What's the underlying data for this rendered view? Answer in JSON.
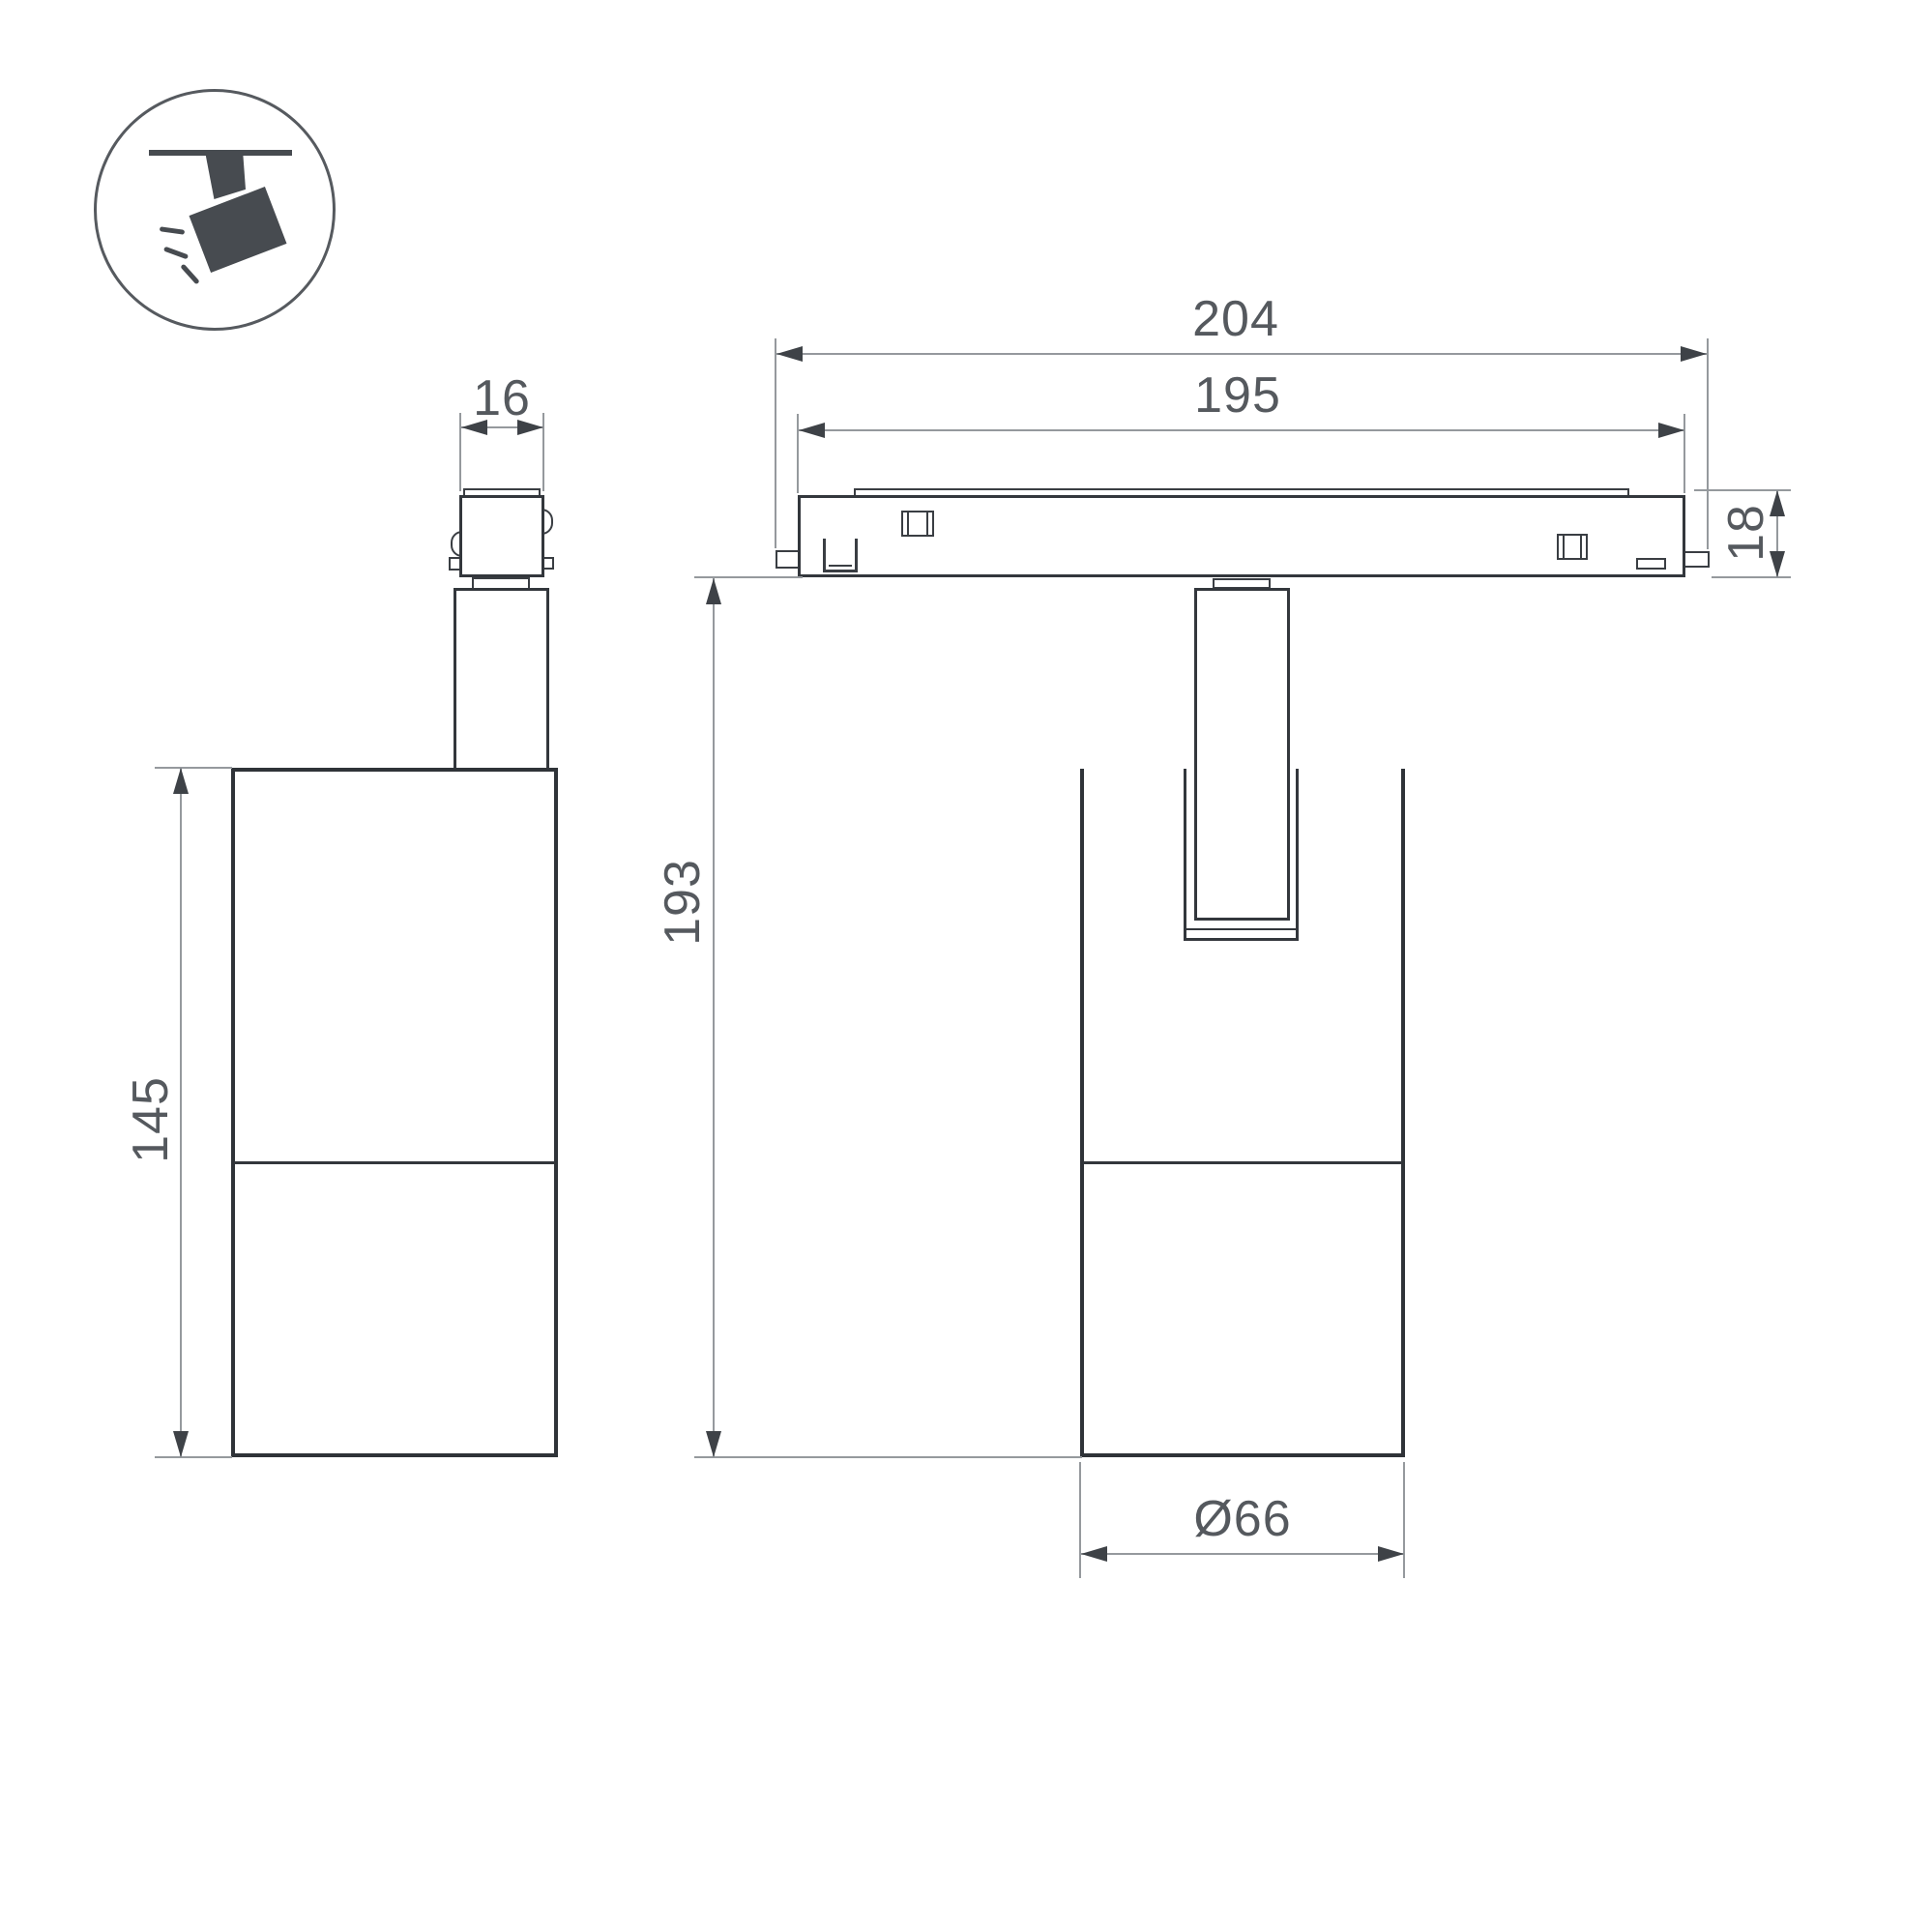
{
  "icon": {
    "name": "ceiling-track-spotlight-icon"
  },
  "dims": {
    "adapter_width": {
      "label": "16"
    },
    "track_length_overall": {
      "label": "204"
    },
    "track_length_body": {
      "label": "195"
    },
    "track_height": {
      "label": "18"
    },
    "fixture_height_overall": {
      "label": "193"
    },
    "body_height": {
      "label": "145"
    },
    "body_diameter": {
      "label": "Ø66"
    }
  },
  "colors": {
    "background": "#ffffff",
    "outline": "#33373c",
    "dimension_line": "#95999d",
    "arrowhead": "#3e4247",
    "text": "#55595e",
    "icon": "#474b50"
  }
}
